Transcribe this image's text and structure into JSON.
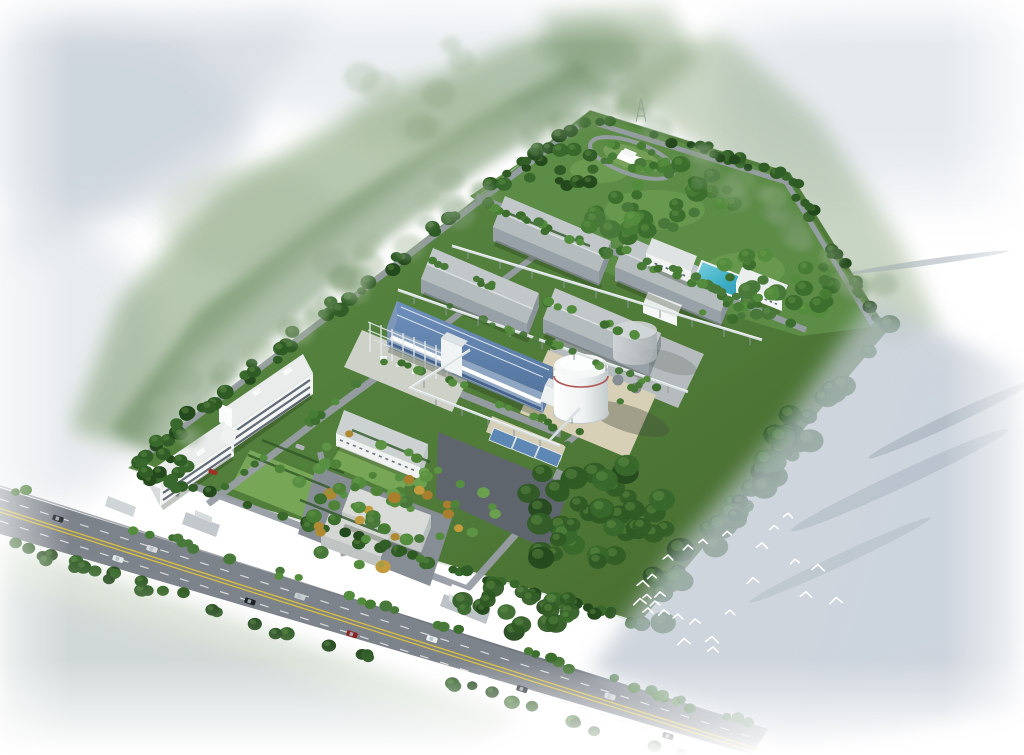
{
  "meta": {
    "description": "Aerial bird's-eye architectural rendering of an industrial plant campus with warehouses, a blue production hall, storage tanks, office buildings, gardens, a park, a pond, a perimeter road with cars, and a flock of white birds over misty water"
  },
  "palettes": {
    "dark": [
      "#24491d",
      "#2e5a24",
      "#38682b",
      "#315d26"
    ],
    "mid": [
      "#3c6e2d",
      "#477c34",
      "#548c3d",
      "#49793a"
    ],
    "light": [
      "#4f8338",
      "#5d9443",
      "#6aa04e",
      "#579043"
    ],
    "autumn": [
      "#b08a33",
      "#c29c3c",
      "#a97f2e"
    ],
    "wash": [
      "#8fa883",
      "#7d9973",
      "#a3b797",
      "#90a98a"
    ]
  },
  "scene": {
    "site": {
      "corners": [
        [
          128,
          468
        ],
        [
          590,
          110
        ],
        [
          790,
          172
        ],
        [
          888,
          330
        ],
        [
          640,
          622
        ]
      ]
    },
    "structures": [
      {
        "name": "warehouse",
        "count": 4
      },
      {
        "name": "blue-production-hall",
        "count": 1
      },
      {
        "name": "steel-pipe-rack-unit",
        "count": 1
      },
      {
        "name": "white-storage-tank",
        "count": 1
      },
      {
        "name": "grey-gas-holder",
        "count": 1
      },
      {
        "name": "office-building",
        "count": 2
      },
      {
        "name": "flat-utility-block",
        "count": 2
      },
      {
        "name": "loading-canopy",
        "count": 3
      },
      {
        "name": "pond",
        "count": 1
      },
      {
        "name": "monument-plaza",
        "count": 1
      },
      {
        "name": "gatehouse",
        "count": 2
      }
    ],
    "vegetation_clusters": [
      {
        "id": "nw-boundary-row",
        "type": "line",
        "from": [
          132,
          464
        ],
        "to": [
          586,
          116
        ],
        "n": 54,
        "rmin": 4.5,
        "rmax": 8.5,
        "palette": "dark",
        "jitter": 6
      },
      {
        "id": "ne-boundary-row1",
        "type": "line",
        "from": [
          596,
          118
        ],
        "to": [
          788,
          176
        ],
        "n": 22,
        "rmin": 4,
        "rmax": 7,
        "palette": "dark",
        "jitter": 5
      },
      {
        "id": "ne-boundary-row2",
        "type": "line",
        "from": [
          792,
          180
        ],
        "to": [
          878,
          326
        ],
        "n": 18,
        "rmin": 4,
        "rmax": 7.5,
        "palette": "dark",
        "jitter": 5
      },
      {
        "id": "se-boundary-mass",
        "type": "line",
        "from": [
          880,
          334
        ],
        "to": [
          646,
          614
        ],
        "n": 46,
        "rmin": 7,
        "rmax": 14,
        "palette": "dark",
        "jitter": 14,
        "opacity": 0.95
      },
      {
        "id": "front-fence-row",
        "type": "line",
        "from": [
          134,
          472
        ],
        "to": [
          634,
          622
        ],
        "n": 46,
        "rmin": 4.5,
        "rmax": 7.5,
        "palette": "dark",
        "jitter": 4,
        "skipNear": [
          [
            208,
            508
          ],
          [
            468,
            594
          ]
        ],
        "skipR": 15
      },
      {
        "id": "road-upper-row",
        "type": "line",
        "from": [
          4,
          486
        ],
        "to": [
          756,
          726
        ],
        "n": 38,
        "rmin": 4,
        "rmax": 6.5,
        "palette": "mid",
        "jitter": 3.5
      },
      {
        "id": "road-lower-row",
        "type": "line",
        "from": [
          0,
          540
        ],
        "to": [
          744,
          776
        ],
        "n": 40,
        "rmin": 5,
        "rmax": 8,
        "palette": "dark",
        "jitter": 5
      },
      {
        "id": "park-clump-1",
        "type": "ellipse",
        "center": [
          650,
          205
        ],
        "rx": 85,
        "ry": 45,
        "n": 40,
        "rmin": 5,
        "rmax": 11,
        "palette": "mid"
      },
      {
        "id": "park-clump-2",
        "type": "ellipse",
        "center": [
          770,
          285
        ],
        "rx": 65,
        "ry": 38,
        "n": 28,
        "rmin": 5,
        "rmax": 10,
        "palette": "mid"
      },
      {
        "id": "park-clump-3",
        "type": "ellipse",
        "center": [
          565,
          165
        ],
        "rx": 45,
        "ry": 22,
        "n": 16,
        "rmin": 4,
        "rmax": 8,
        "palette": "dark"
      },
      {
        "id": "plaza-ring-trees",
        "type": "ellipse",
        "center": [
          632,
          158
        ],
        "rx": 46,
        "ry": 18,
        "n": 10,
        "rmin": 3.5,
        "rmax": 5,
        "palette": "mid"
      },
      {
        "id": "park-edge-row",
        "type": "line",
        "from": [
          480,
          200
        ],
        "to": [
          800,
          328
        ],
        "n": 20,
        "rmin": 4,
        "rmax": 6.5,
        "palette": "mid"
      },
      {
        "id": "office-garden-1",
        "type": "ellipse",
        "center": [
          350,
          475
        ],
        "rx": 75,
        "ry": 42,
        "n": 26,
        "rmin": 4,
        "rmax": 7,
        "palette": "light",
        "autumn": 0.2
      },
      {
        "id": "office-garden-2",
        "type": "ellipse",
        "center": [
          445,
          505
        ],
        "rx": 55,
        "ry": 38,
        "n": 18,
        "rmin": 4,
        "rmax": 7,
        "palette": "light",
        "autumn": 0.2
      },
      {
        "id": "courtyard-ring",
        "type": "ellipse",
        "center": [
          375,
          525
        ],
        "rx": 70,
        "ry": 45,
        "n": 24,
        "rmin": 4.5,
        "rmax": 8,
        "palette": "mid",
        "autumn": 0.25
      },
      {
        "id": "warehouse-row-a",
        "type": "line",
        "from": [
          492,
          206
        ],
        "to": [
          600,
          250
        ],
        "n": 9,
        "rmin": 3.5,
        "rmax": 5.5,
        "palette": "mid"
      },
      {
        "id": "warehouse-row-b",
        "type": "line",
        "from": [
          614,
          246
        ],
        "to": [
          722,
          290
        ],
        "n": 9,
        "rmin": 3.5,
        "rmax": 5.5,
        "palette": "mid"
      },
      {
        "id": "warehouse-row-c",
        "type": "line",
        "from": [
          420,
          258
        ],
        "to": [
          528,
          302
        ],
        "n": 9,
        "rmin": 3.5,
        "rmax": 5.5,
        "palette": "mid"
      },
      {
        "id": "warehouse-row-d",
        "type": "line",
        "from": [
          542,
          298
        ],
        "to": [
          650,
          342
        ],
        "n": 9,
        "rmin": 3.5,
        "rmax": 5.5,
        "palette": "mid"
      },
      {
        "id": "r6-row",
        "type": "line",
        "from": [
          390,
          358
        ],
        "to": [
          556,
          426
        ],
        "n": 13,
        "rmin": 3.5,
        "rmax": 5.5,
        "palette": "mid"
      },
      {
        "id": "gate-road-row",
        "type": "line",
        "from": [
          212,
          496
        ],
        "to": [
          386,
          362
        ],
        "n": 12,
        "rmin": 3.5,
        "rmax": 5.5,
        "palette": "mid"
      },
      {
        "id": "tank-pad-row",
        "type": "line",
        "from": [
          548,
          342
        ],
        "to": [
          666,
          392
        ],
        "n": 9,
        "rmin": 3.5,
        "rmax": 5,
        "palette": "mid"
      },
      {
        "id": "yard-right-row",
        "type": "line",
        "from": [
          566,
          446
        ],
        "to": [
          650,
          376
        ],
        "n": 8,
        "rmin": 3.5,
        "rmax": 5,
        "palette": "mid"
      },
      {
        "id": "pond-area",
        "type": "ellipse",
        "center": [
          722,
          298
        ],
        "rx": 42,
        "ry": 22,
        "n": 12,
        "rmin": 3.5,
        "rmax": 6,
        "palette": "mid"
      },
      {
        "id": "west-corner-cluster",
        "type": "ellipse",
        "center": [
          168,
          468
        ],
        "rx": 32,
        "ry": 20,
        "n": 13,
        "rmin": 4.5,
        "rmax": 8,
        "palette": "dark"
      },
      {
        "id": "se-inner-mass-1",
        "type": "ellipse",
        "center": [
          598,
          515
        ],
        "rx": 85,
        "ry": 60,
        "n": 42,
        "rmin": 7,
        "rmax": 14,
        "palette": "dark",
        "opacity": 0.95
      },
      {
        "id": "se-inner-mass-2",
        "type": "ellipse",
        "center": [
          520,
          605
        ],
        "rx": 60,
        "ry": 30,
        "n": 20,
        "rmin": 6,
        "rmax": 11,
        "palette": "dark",
        "opacity": 0.95
      },
      {
        "id": "plant-scatter",
        "type": "line",
        "from": [
          430,
          300
        ],
        "to": [
          620,
          370
        ],
        "n": 8,
        "rmin": 3,
        "rmax": 5,
        "palette": "mid",
        "opacity": 0.9
      },
      {
        "id": "nw-outer-wash",
        "type": "line",
        "from": [
          150,
          440
        ],
        "to": [
          575,
          105
        ],
        "n": 34,
        "rmin": 9,
        "rmax": 18,
        "palette": "wash",
        "opacity": 0.35,
        "soft": true,
        "jitter": 22
      },
      {
        "id": "ne-outer-wash",
        "type": "line",
        "from": [
          615,
          95
        ],
        "to": [
          895,
          305
        ],
        "n": 28,
        "rmin": 8,
        "rmax": 16,
        "palette": "wash",
        "opacity": 0.3,
        "soft": true,
        "jitter": 18
      },
      {
        "id": "top-outer-wash",
        "type": "ellipse",
        "center": [
          500,
          90
        ],
        "rx": 150,
        "ry": 60,
        "n": 22,
        "rmin": 10,
        "rmax": 20,
        "palette": "wash",
        "opacity": 0.25,
        "soft": true
      }
    ],
    "birds": {
      "color": "#ffffff",
      "points": [
        [
          640,
          601,
          1
        ],
        [
          647,
          596,
          0
        ],
        [
          655,
          603,
          1
        ],
        [
          648,
          610,
          0
        ],
        [
          664,
          612,
          1
        ],
        [
          678,
          616,
          0
        ],
        [
          695,
          621,
          1
        ],
        [
          712,
          639,
          0
        ],
        [
          660,
          594,
          1
        ],
        [
          643,
          583,
          0
        ],
        [
          652,
          576,
          1
        ],
        [
          668,
          557,
          0
        ],
        [
          688,
          547,
          1
        ],
        [
          703,
          541,
          0
        ],
        [
          727,
          533,
          1
        ],
        [
          762,
          545,
          0
        ],
        [
          774,
          527,
          1
        ],
        [
          788,
          515,
          0
        ],
        [
          795,
          561,
          1
        ],
        [
          806,
          594,
          0
        ],
        [
          836,
          600,
          1
        ],
        [
          818,
          567,
          0
        ],
        [
          684,
          641,
          1
        ],
        [
          713,
          649,
          0
        ],
        [
          753,
          580,
          1
        ],
        [
          730,
          612,
          0
        ]
      ]
    },
    "traffic": {
      "main_road": {
        "slope": 0.322,
        "upper_intercept": 500,
        "lower_intercept": 521,
        "angle_deg": 17.8
      },
      "cars": [
        {
          "x": 58,
          "lane": 0,
          "c": "#23262b"
        },
        {
          "x": 118,
          "lane": 1,
          "c": "#e6e8e8"
        },
        {
          "x": 152,
          "lane": 0,
          "c": "#d8dadb"
        },
        {
          "x": 250,
          "lane": 1,
          "c": "#1e2126"
        },
        {
          "x": 300,
          "lane": 0,
          "c": "#c9cccf"
        },
        {
          "x": 352,
          "lane": 1,
          "c": "#8c2222"
        },
        {
          "x": 432,
          "lane": 0,
          "c": "#eceeee"
        },
        {
          "x": 522,
          "lane": 1,
          "c": "#2a2e34"
        },
        {
          "x": 610,
          "lane": 0,
          "c": "#d2d4d6"
        },
        {
          "x": 668,
          "lane": 1,
          "c": "#17191c"
        }
      ],
      "internal_cars": [
        {
          "x": 213,
          "y": 472,
          "c": "#a03026"
        },
        {
          "x": 300,
          "y": 447,
          "c": "#b0b4b8"
        }
      ],
      "parked_cars": [
        {
          "x": 152,
          "y": 474
        },
        {
          "x": 159,
          "y": 477
        },
        {
          "x": 166,
          "y": 480
        }
      ]
    }
  }
}
